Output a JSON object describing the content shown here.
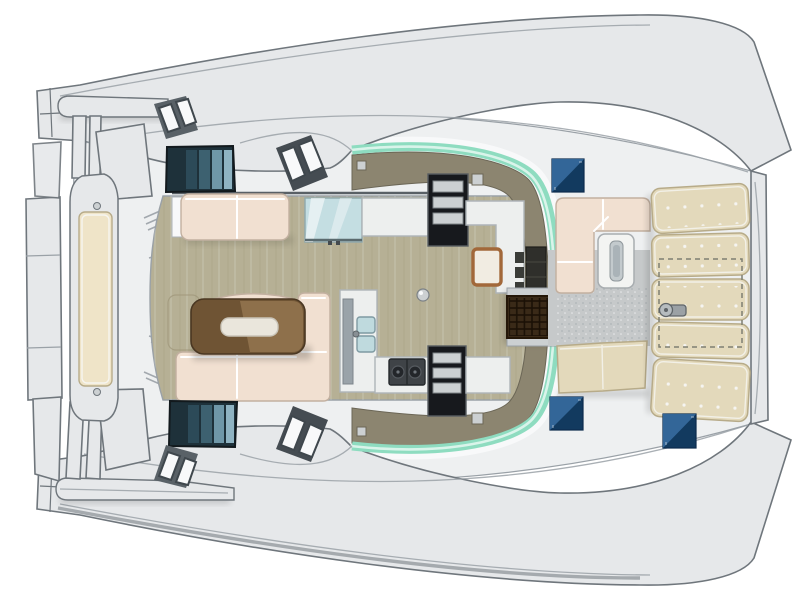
{
  "figure": {
    "type": "catamaran-deck-plan",
    "view": "top-down",
    "visible_text": []
  },
  "palette": {
    "bg": "#ffffff",
    "hullFill": "#e6e8ea",
    "hullShade": "#cfd3d6",
    "hullEdge": "#6f767c",
    "deckFill": "#eef0f1",
    "deckLine": "#9aa1a7",
    "whiteTrim": "#f8f9fa",
    "floorWood": "#b6b095",
    "floorGrain": "#9e9679",
    "oliveBand": "#8c8570",
    "oliveDark": "#6b6656",
    "greenGlass": "#8edcc0",
    "greenLight": "#d9f4ea",
    "sofaCream": "#f1e0d1",
    "sofaPiping": "#ffffff",
    "sofaShade": "#c2b0a0",
    "sunpadTan": "#e3d9bb",
    "sunpadSeam": "#b7ab89",
    "benchCream": "#efe4c8",
    "tableWood": "#6f5434",
    "tableWoodLight": "#a8865e",
    "trayWhite": "#eae6dc",
    "windowDark": "#1e313a",
    "windowPane1": "#2c4a58",
    "windowPane2": "#3d6170",
    "windowPane3": "#6f97a8",
    "windowPane4": "#8fb3c2",
    "hatchBlueA": "#3a6fa2",
    "hatchBlueB": "#123a5f",
    "counterWhite": "#edefee",
    "counterEdge": "#aeb4b8",
    "stairDark": "#17191d",
    "stairStep": "#ccd0d2",
    "grateBrown": "#3a2a18",
    "grateLine": "#1b1106",
    "chartGlass": "#c4dee2",
    "sinkBlue": "#bfdade",
    "stoveDark": "#3f4347",
    "steelGray": "#9ba1a5",
    "textureGray": "#c6c9ca",
    "shadow": "#000000"
  },
  "regions": [
    {
      "name": "port-hull",
      "kind": "hull-band"
    },
    {
      "name": "starboard-hull",
      "kind": "hull-band"
    },
    {
      "name": "bridge-deck",
      "kind": "deck"
    },
    {
      "name": "stern-platform",
      "kind": "aft-platform-with-bench"
    },
    {
      "name": "saloon-floor",
      "kind": "wood-floor"
    },
    {
      "name": "saloon-windshield",
      "kind": "curved-green-glass"
    },
    {
      "name": "dining-table",
      "kind": "table-with-tray"
    },
    {
      "name": "dining-sofa",
      "kind": "l-shaped-sofa"
    },
    {
      "name": "top-sofa",
      "kind": "two-seat-sofa"
    },
    {
      "name": "chart-table",
      "kind": "glass-top"
    },
    {
      "name": "galley",
      "kind": "sink-and-stove"
    },
    {
      "name": "companionway-stairs-port",
      "kind": "stairs"
    },
    {
      "name": "companionway-stairs-starboard",
      "kind": "stairs"
    },
    {
      "name": "entry-door-grate",
      "kind": "teak-grate"
    },
    {
      "name": "forward-cockpit",
      "kind": "sofa-table-bench"
    },
    {
      "name": "foredeck-sunpads",
      "kind": "tufted-cushions"
    },
    {
      "name": "windlass",
      "kind": "anchor-winch"
    },
    {
      "name": "deck-hatches",
      "kind": "blue-glass-hatches"
    },
    {
      "name": "hull-windows",
      "kind": "dark-teal-windows"
    },
    {
      "name": "hull-skylights",
      "kind": "tilted-hatch-pairs"
    }
  ]
}
